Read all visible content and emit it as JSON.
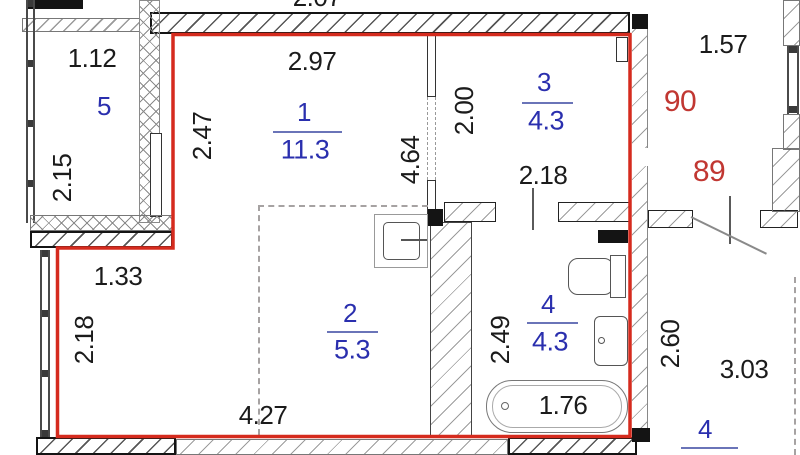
{
  "title": "apartment-floor-plan",
  "colors": {
    "apartment_outline_red": "#d52b1e",
    "room_label_blue": "#2a2fae",
    "unit_number_red": "#c13732",
    "dimension_black": "#1b1b1b",
    "wall_black": "#141414",
    "hatch_gray": "#9a9a9a"
  },
  "rooms": {
    "r1": {
      "number": "1",
      "area": "11.3"
    },
    "r2": {
      "number": "2",
      "area": "5.3"
    },
    "r3": {
      "number": "3",
      "area": "4.3"
    },
    "r4": {
      "number": "4",
      "area": "4.3"
    },
    "r5": {
      "number": "5"
    },
    "r4_neighbor": {
      "number": "4"
    }
  },
  "unit_numbers": {
    "upper": "90",
    "lower": "89"
  },
  "dims": {
    "top_partial": "2.07",
    "room5_width": "1.12",
    "room5_height": "2.15",
    "room1_width": "2.97",
    "room1_height": "2.47",
    "hall_height": "4.64",
    "room3_left_height": "2.00",
    "room3_width": "2.18",
    "corridor_width": "1.57",
    "niche_offset": "1.33",
    "room2_left_height": "2.18",
    "room2_width": "4.27",
    "bath_height": "2.49",
    "bathtub_length": "1.76",
    "right_room_height": "2.60",
    "right_room_width": "3.03"
  }
}
